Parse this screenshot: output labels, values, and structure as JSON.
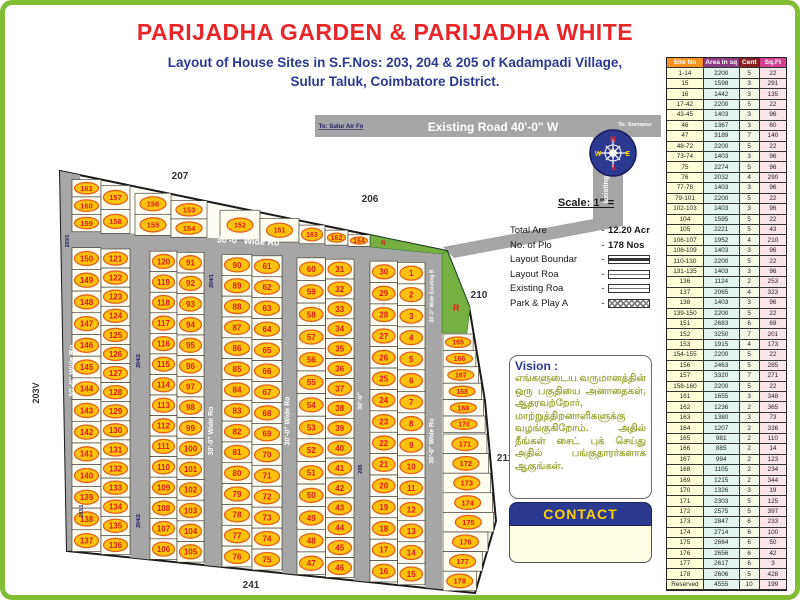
{
  "header": {
    "title": "PARIJADHA GARDEN & PARIJADHA WHITE",
    "subtitle1": "Layout of House Sites in S.F.Nos: 203, 204 & 205 of Kadampadi Village,",
    "subtitle2": "Sulur Taluk, Coimbatore District."
  },
  "colors": {
    "title_red": "#E8262A",
    "blue": "#2B3990",
    "frame_green": "#80BD33",
    "road_gray": "#A6A6A6",
    "park_green": "#76B041",
    "oval_yellow": "#FFC20E",
    "oval_ring": "#E2621B",
    "plot_number_red": "#D91E18",
    "contact_yellow": "#FFD200"
  },
  "map": {
    "existing_road_label": "Existing Road 40'-0\" W",
    "to_left": "To: Sulur Air Fo",
    "to_right": "To: Somanur",
    "existing_road_vertical_label": "Existing R",
    "wide_existing_label": "30'-0\" Wide Existing R",
    "road_label": "30'-0\" Wide Ro",
    "road_label_short": "30'-0\"",
    "park_label": "R",
    "compass": {
      "n": "N",
      "e": "E",
      "s": "S",
      "w": "W"
    },
    "survey": {
      "s207": "207",
      "s206": "206",
      "s210": "210",
      "s211": "211",
      "s241": "241",
      "s203v": "203V",
      "s203_1": "203/1",
      "s204_1": "204/1",
      "s204_2": "204/2",
      "s205": "205"
    },
    "plots": {
      "top_block1": [
        [
          "161",
          "160",
          "159"
        ],
        [
          "157",
          "158"
        ]
      ],
      "top_block2": [
        [
          "156",
          "155"
        ],
        [
          "153",
          "154"
        ]
      ],
      "top_strip": [
        "152",
        "151",
        "163",
        "162",
        "164"
      ],
      "blocks": [
        [
          [
            "150",
            "149",
            "148",
            "147",
            "146",
            "145",
            "144",
            "143",
            "142",
            "141",
            "140",
            "139",
            "138",
            "137"
          ],
          [
            "121",
            "122",
            "123",
            "124",
            "125",
            "126",
            "127",
            "128",
            "129",
            "130",
            "131",
            "132",
            "133",
            "134",
            "135",
            "136"
          ]
        ],
        [
          [
            "120",
            "119",
            "118",
            "117",
            "116",
            "115",
            "114",
            "113",
            "112",
            "111",
            "110",
            "109",
            "108",
            "107",
            "106"
          ],
          [
            "91",
            "92",
            "93",
            "94",
            "95",
            "96",
            "97",
            "98",
            "99",
            "100",
            "101",
            "102",
            "103",
            "104",
            "105"
          ]
        ],
        [
          [
            "90",
            "89",
            "88",
            "87",
            "86",
            "85",
            "84",
            "83",
            "82",
            "81",
            "80",
            "79",
            "78",
            "77",
            "76"
          ],
          [
            "61",
            "62",
            "63",
            "64",
            "65",
            "66",
            "67",
            "68",
            "69",
            "70",
            "71",
            "72",
            "73",
            "74",
            "75"
          ]
        ],
        [
          [
            "60",
            "59",
            "58",
            "57",
            "56",
            "55",
            "54",
            "53",
            "52",
            "51",
            "50",
            "49",
            "48",
            "47"
          ],
          [
            "31",
            "32",
            "33",
            "34",
            "35",
            "36",
            "37",
            "38",
            "39",
            "40",
            "41",
            "42",
            "43",
            "44",
            "45",
            "46"
          ]
        ],
        [
          [
            "30",
            "29",
            "28",
            "27",
            "26",
            "25",
            "24",
            "23",
            "22",
            "21",
            "20",
            "19",
            "18",
            "17",
            "16"
          ],
          [
            "1",
            "2",
            "3",
            "4",
            "5",
            "6",
            "7",
            "8",
            "9",
            "10",
            "11",
            "12",
            "13",
            "14",
            "15"
          ]
        ]
      ],
      "right_small": [
        "165",
        "166",
        "167",
        "168",
        "169",
        "170"
      ],
      "right_large": [
        "171",
        "172",
        "173",
        "174",
        "175",
        "176",
        "177",
        "178"
      ]
    }
  },
  "legend": {
    "scale_label": "Scale: 1\" =",
    "rows": [
      {
        "label": "Total Are",
        "dash": "-",
        "value": "12.20 Acr",
        "swatch": "none"
      },
      {
        "label": "No. of Plo",
        "dash": "-",
        "value": "178 Nos",
        "swatch": "none"
      },
      {
        "label": "Layout Boundar",
        "dash": "-",
        "value": "",
        "swatch": "boundary"
      },
      {
        "label": "Layout Roa",
        "dash": "-",
        "value": "",
        "swatch": "road"
      },
      {
        "label": "Existing Roa",
        "dash": "-",
        "value": "",
        "swatch": "road"
      },
      {
        "label": "Park & Play A",
        "dash": "-",
        "value": "",
        "swatch": "hatch"
      }
    ]
  },
  "vision": {
    "title": "Vision :",
    "body": "எங்களுடைய வருமானத்தின் ஒரு பகுதியை அனாதைகள், ஆதரவற்றோர், மாற்றுத்திறனாளிகளுக்கு வழங்குகிறோம். அதில் நீங்கள் சைட் புக் செய்து அதில் பங்குதாரர்களாக ஆகுங்கள்."
  },
  "contact": {
    "label": "CONTACT"
  },
  "table": {
    "headers": [
      {
        "label": "Site No",
        "color": "#F6921E"
      },
      {
        "label": "Area in sq",
        "color": "#8E3A80"
      },
      {
        "label": "Cent",
        "color": "#8B2020"
      },
      {
        "label": "Sq.Ft",
        "color": "#D4418E"
      }
    ],
    "col_bg": [
      "#FEFFD6",
      "#E4F5EF",
      "#F5F9E8",
      "#FBE4EA"
    ],
    "rows": [
      [
        "1-14",
        "2200",
        "5",
        "22"
      ],
      [
        "15",
        "1598",
        "3",
        "291"
      ],
      [
        "16",
        "1442",
        "3",
        "135"
      ],
      [
        "17-42",
        "2200",
        "5",
        "22"
      ],
      [
        "43-45",
        "1403",
        "3",
        "96"
      ],
      [
        "46",
        "1367",
        "3",
        "60"
      ],
      [
        "47",
        "3189",
        "7",
        "140"
      ],
      [
        "48-72",
        "2200",
        "5",
        "22"
      ],
      [
        "73-74",
        "1403",
        "3",
        "96"
      ],
      [
        "75",
        "2274",
        "5",
        "96"
      ],
      [
        "76",
        "2032",
        "4",
        "290"
      ],
      [
        "77-78",
        "1403",
        "3",
        "96"
      ],
      [
        "79-101",
        "2200",
        "5",
        "22"
      ],
      [
        "102-103",
        "1403",
        "3",
        "96"
      ],
      [
        "104",
        "1595",
        "5",
        "22"
      ],
      [
        "105",
        "2221",
        "5",
        "43"
      ],
      [
        "106-107",
        "1952",
        "4",
        "210"
      ],
      [
        "108-109",
        "1403",
        "3",
        "96"
      ],
      [
        "110-130",
        "2200",
        "5",
        "22"
      ],
      [
        "131-135",
        "1403",
        "3",
        "96"
      ],
      [
        "136",
        "1124",
        "2",
        "253"
      ],
      [
        "137",
        "2065",
        "4",
        "323"
      ],
      [
        "138",
        "1403",
        "3",
        "96"
      ],
      [
        "139-150",
        "2200",
        "5",
        "22"
      ],
      [
        "151",
        "2683",
        "6",
        "69"
      ],
      [
        "152",
        "3250",
        "7",
        "201"
      ],
      [
        "153",
        "1915",
        "4",
        "173"
      ],
      [
        "154-155",
        "2200",
        "5",
        "22"
      ],
      [
        "156",
        "2463",
        "5",
        "285"
      ],
      [
        "157",
        "3320",
        "7",
        "271"
      ],
      [
        "158-160",
        "2200",
        "5",
        "22"
      ],
      [
        "161",
        "1655",
        "3",
        "348"
      ],
      [
        "162",
        "1236",
        "2",
        "365"
      ],
      [
        "163",
        "1380",
        "3",
        "73"
      ],
      [
        "164",
        "1207",
        "2",
        "336"
      ],
      [
        "165",
        "981",
        "2",
        "110"
      ],
      [
        "166",
        "885",
        "2",
        "14"
      ],
      [
        "167",
        "994",
        "2",
        "123"
      ],
      [
        "168",
        "1105",
        "2",
        "234"
      ],
      [
        "169",
        "1215",
        "2",
        "344"
      ],
      [
        "170",
        "1326",
        "3",
        "19"
      ],
      [
        "171",
        "2303",
        "5",
        "125"
      ],
      [
        "172",
        "2575",
        "5",
        "397"
      ],
      [
        "173",
        "2847",
        "6",
        "233"
      ],
      [
        "174",
        "2714",
        "6",
        "100"
      ],
      [
        "175",
        "2664",
        "6",
        "50"
      ],
      [
        "176",
        "2656",
        "6",
        "42"
      ],
      [
        "177",
        "2617",
        "6",
        "3"
      ],
      [
        "178",
        "2606",
        "5",
        "428"
      ],
      [
        "Reserved",
        "4555",
        "10",
        "199"
      ]
    ]
  }
}
